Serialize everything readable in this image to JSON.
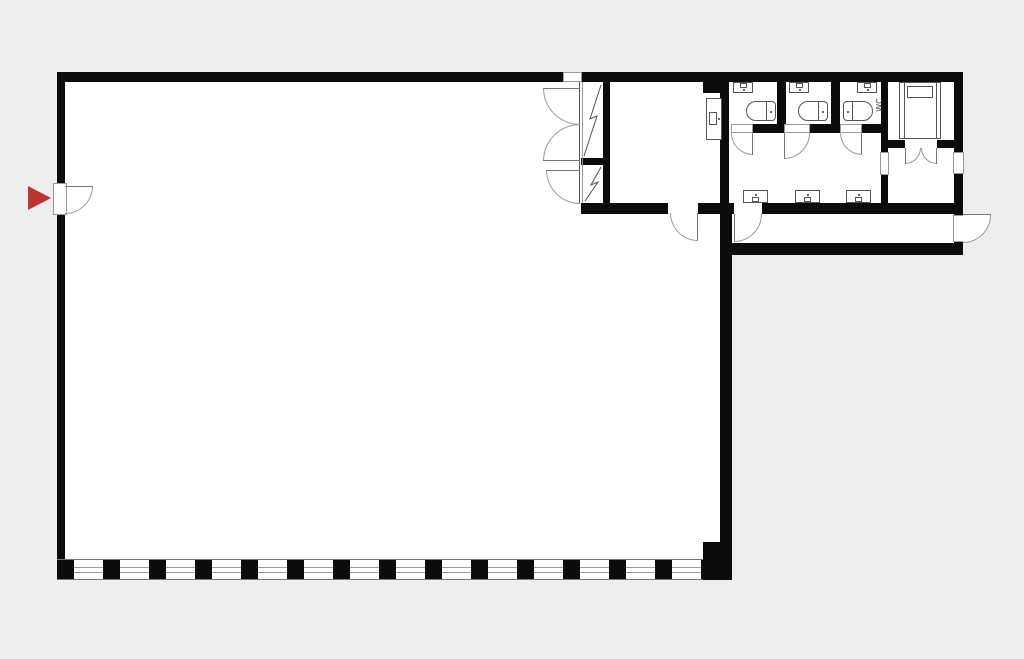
{
  "title": "Floor plan",
  "labels": {
    "wc": "WC"
  },
  "colors": {
    "background": "#eeeeee",
    "floor": "#ffffff",
    "wall": "#0c0c0c",
    "thin_line": "#999999",
    "fixture_line": "#555555",
    "entrance_marker_red": "#b93733"
  },
  "plan": {
    "type": "floor-plan",
    "rooms_depicted": [
      "main-hall",
      "closet-with-shaft",
      "side-room",
      "wc-stall-1",
      "wc-stall-2",
      "wc-stall-3",
      "washroom",
      "wc-room",
      "vestibule",
      "corridor"
    ],
    "fixtures_depicted": {
      "toilets": 3,
      "stall_hand_basins": 3,
      "washroom_basins": 3,
      "side_room_basin": 1,
      "shower_unit": 1,
      "bottom_window_band": true,
      "entrance_arrow_marker": true,
      "swing_doors": 12
    }
  }
}
